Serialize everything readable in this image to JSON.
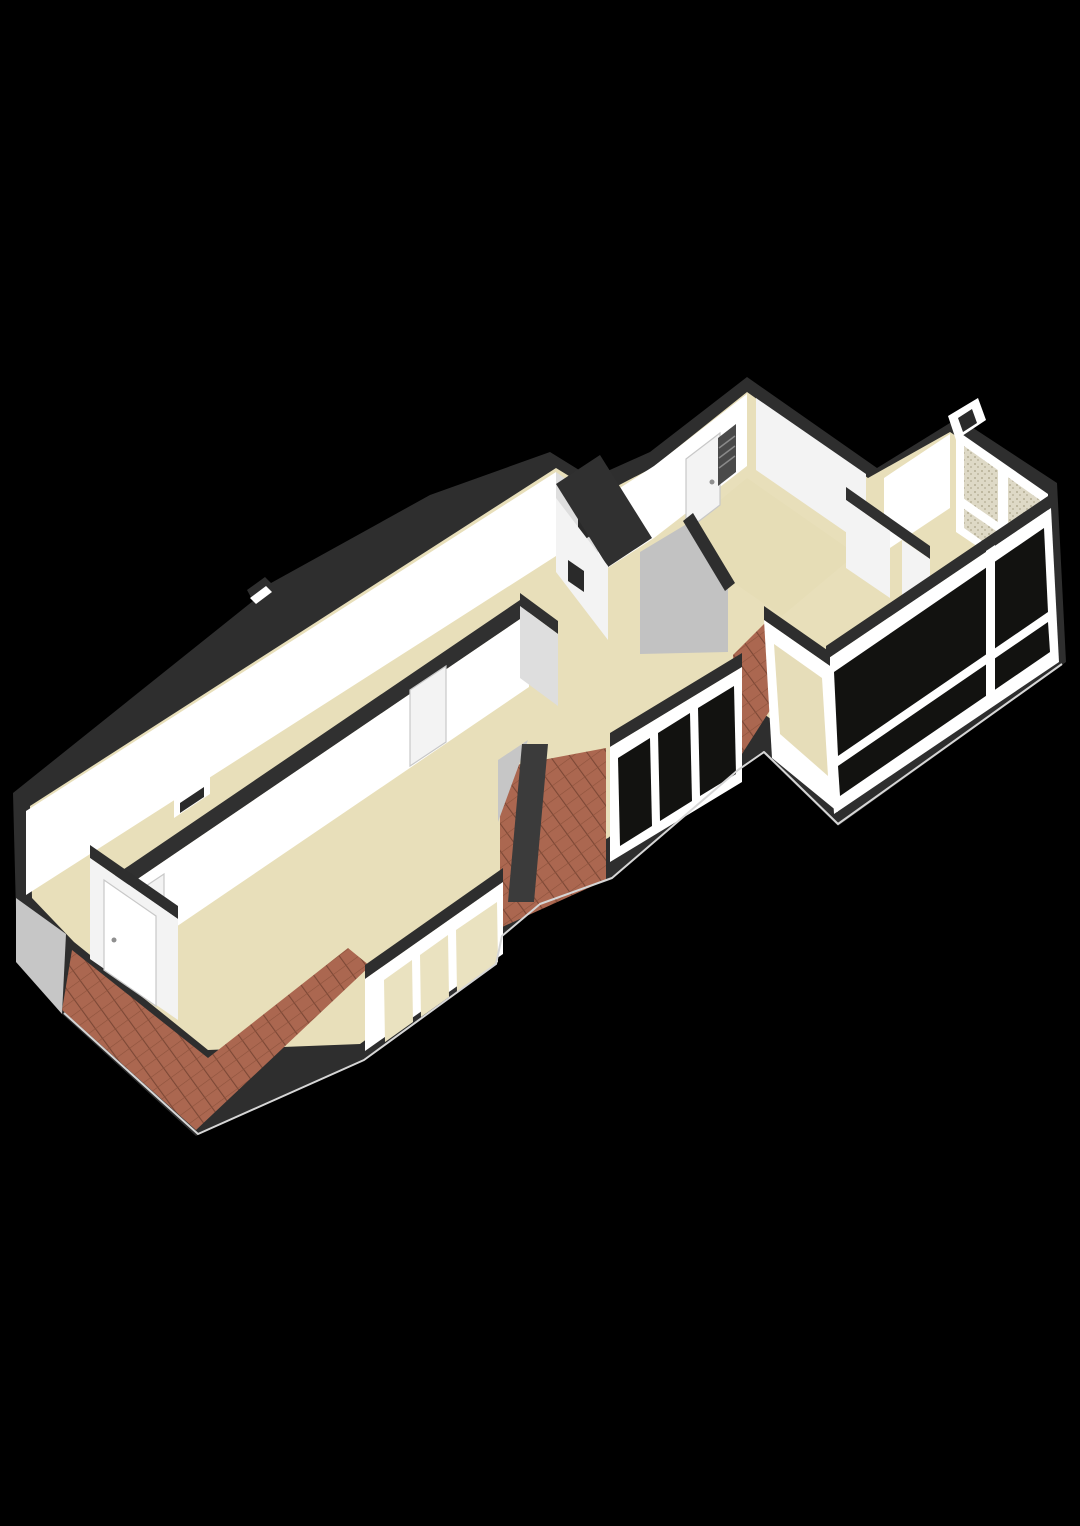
{
  "scene": {
    "canvas": {
      "width": 1080,
      "height": 1526
    },
    "background": "#000000",
    "palette": {
      "wallCap": "#2e2e2e",
      "wallCapSoft": "#303030",
      "wallWhite": "#ffffff",
      "wallLight": "#f3f3f3",
      "wallShade": "#dedede",
      "wallGray": "#c4c4c4",
      "gableGray": "#c6c6c6",
      "chamferGray": "#c2c2c2",
      "floor": "#e8dfba",
      "floorNook": "#e6ddb6",
      "paneDark": "#121210",
      "paneBeige": "#e6ddb9",
      "paneBeigeLight": "#eae2c0",
      "tileBase": "#ab6750",
      "tileLine": "#7c4836",
      "tileRow": "#8d523c",
      "chimney": "#3b3b3b",
      "frostBase": "#ded9c6",
      "frostDot": "#b4ad94",
      "edgeLight": "#d6d6d6",
      "doorFrame": "#c8c8c8",
      "handleGray": "#8f8f8f",
      "slotDark": "#2a2a2a",
      "radiator": "#4a4a4a",
      "radiatorLine": "#8a8a8a"
    },
    "elements": [
      {
        "name": "building-silhouette-walls-cap",
        "kind": "polygon",
        "fill": "wallCap",
        "points": "13,793 253,601 247,590 265,577 271,583 430,495 550,452 592,478 650,452 747,377 877,468 958,418 1057,483 1066,662 838,826 762,752 736,770 610,880 538,906 500,938 494,966 362,1062 196,1136 62,1014 16,912"
      },
      {
        "name": "roof-vent-box",
        "kind": "polygon",
        "fill": "wallWhite",
        "points": "250,598 266,586 272,592 256,604"
      },
      {
        "name": "floor-main",
        "kind": "polygon",
        "fill": "floor",
        "points": "30,806 556,468 600,495 652,468 747,392 868,478 950,432 1046,496 1048,610 834,766 764,714 736,734 608,838 536,872 498,898 494,946 360,1044 208,1050 74,942 32,898"
      },
      {
        "name": "back-wall-face",
        "kind": "polygon",
        "fill": "wallWhite",
        "points": "26,811 556,472 556,556 26,895"
      },
      {
        "name": "back-wall-step-face",
        "kind": "polygon",
        "fill": "wallShade",
        "points": "556,472 598,502 598,584 556,554"
      },
      {
        "name": "step-niche-slot",
        "kind": "polygon",
        "fill": "slotDark",
        "points": "578,503 590,495 590,536 578,544"
      },
      {
        "name": "mid-back-wall-face",
        "kind": "polygon",
        "fill": "wallWhite",
        "points": "598,502 654,466 654,538 598,574"
      },
      {
        "name": "entry-nook-left-wall",
        "kind": "polygon",
        "fill": "wallWhite",
        "points": "654,466 747,394 747,466 654,538"
      },
      {
        "name": "entry-nook-right-wall",
        "kind": "polygon",
        "fill": "wallLight",
        "points": "756,398 866,474 866,546 756,470"
      },
      {
        "name": "entry-nook-floor",
        "kind": "polygon",
        "fill": "floorNook",
        "points": "672,540 747,478 856,554 782,616"
      },
      {
        "name": "entry-door-leaf",
        "kind": "polygon",
        "fill": "wallLight",
        "stroke": "doorFrame",
        "points": "686,459 720,433 720,505 686,531"
      },
      {
        "name": "entry-door-handle",
        "kind": "circle",
        "cx": 712,
        "cy": 482,
        "r": 2.5,
        "fill": "handleGray"
      },
      {
        "name": "radiator-shaft",
        "kind": "polygon",
        "fill": "radiator",
        "points": "718,438 736,424 736,472 718,486"
      },
      {
        "name": "radiator-stripe-1",
        "kind": "polyline",
        "stroke": "radiatorLine",
        "width": 1.5,
        "points": "719,448 735,436"
      },
      {
        "name": "radiator-stripe-2",
        "kind": "polyline",
        "stroke": "radiatorLine",
        "width": 1.5,
        "points": "719,458 735,446"
      },
      {
        "name": "radiator-stripe-3",
        "kind": "polyline",
        "stroke": "radiatorLine",
        "width": 1.5,
        "points": "719,468 735,456"
      },
      {
        "name": "right-back-wall-face",
        "kind": "polygon",
        "fill": "wallWhite",
        "points": "884,478 950,434 950,508 884,552"
      },
      {
        "name": "corner-duct-box",
        "kind": "polygon",
        "fill": "wallWhite",
        "points": "948,416 978,398 986,420 956,440"
      },
      {
        "name": "corner-duct-slot",
        "kind": "polygon",
        "fill": "slotDark",
        "points": "958,418 972,409 977,423 963,432"
      },
      {
        "name": "frosted-window-frame",
        "kind": "polygon",
        "fill": "wallWhite",
        "points": "956,430 1048,494 1048,594 956,532"
      },
      {
        "name": "frosted-window-pane",
        "kind": "polygon",
        "fill": "pattern:speckle",
        "points": "964,446 1040,500 1040,582 964,528"
      },
      {
        "name": "frosted-window-mullion",
        "kind": "polygon",
        "fill": "wallWhite",
        "points": "998,462 1008,469 1008,564 998,557"
      },
      {
        "name": "frosted-window-rail",
        "kind": "polygon",
        "fill": "wallWhite",
        "points": "960,496 1044,554 1044,564 960,506"
      },
      {
        "name": "hall-partition-cap",
        "kind": "polygon",
        "fill": "wallCapSoft",
        "points": "846,487 930,546 930,559 846,500"
      },
      {
        "name": "hall-partition-face-left",
        "kind": "polygon",
        "fill": "wallLight",
        "points": "846,500 890,531 890,598 846,568"
      },
      {
        "name": "hall-partition-face-right",
        "kind": "polygon",
        "fill": "wallLight",
        "points": "902,540 930,559 930,627 902,608"
      },
      {
        "name": "sloped-ceiling-chamfer",
        "kind": "polygon",
        "fill": "chamferGray",
        "points": "640,552 690,522 728,586 728,652 640,654"
      },
      {
        "name": "sloped-ceiling-chamfer-cap",
        "kind": "polygon",
        "fill": "wallCap",
        "points": "683,521 693,513 735,583 725,591"
      },
      {
        "name": "closet-cap",
        "kind": "polygon",
        "fill": "wallCapSoft",
        "points": "556,484 600,455 652,538 608,567"
      },
      {
        "name": "closet-face",
        "kind": "polygon",
        "fill": "wallLight",
        "points": "556,498 608,566 608,640 556,572"
      },
      {
        "name": "closet-niche-slot",
        "kind": "polygon",
        "fill": "slotDark",
        "points": "568,560 584,571 584,592 568,581"
      },
      {
        "name": "longwall-cap",
        "kind": "polygon",
        "fill": "wallCapSoft",
        "points": "108,880 520,600 529,613 117,893"
      },
      {
        "name": "longwall-face",
        "kind": "polygon",
        "fill": "wallWhite",
        "points": "117,893 529,613 529,687 117,967"
      },
      {
        "name": "longwall-hatch-frame",
        "kind": "polygon",
        "fill": "wallWhite",
        "points": "174,800 210,776 210,794 174,818"
      },
      {
        "name": "longwall-hatch-slot",
        "kind": "polygon",
        "fill": "slotDark",
        "points": "180,803 204,787 204,797 180,813"
      },
      {
        "name": "longwall-door-left",
        "kind": "polygon",
        "fill": "wallLight",
        "stroke": "doorFrame",
        "points": "128,898 164,874 164,952 128,976"
      },
      {
        "name": "longwall-door-right",
        "kind": "polygon",
        "fill": "wallLight",
        "stroke": "doorFrame",
        "points": "410,690 446,666 446,742 410,766"
      },
      {
        "name": "room-end-wall-cap",
        "kind": "polygon",
        "fill": "wallCapSoft",
        "points": "520,593 558,621 558,634 520,606"
      },
      {
        "name": "room-end-wall-face",
        "kind": "polygon",
        "fill": "wallShade",
        "points": "520,606 558,634 558,706 520,678"
      },
      {
        "name": "left-front-wall-cap",
        "kind": "polygon",
        "fill": "wallCap",
        "points": "90,845 178,906 178,919 90,858"
      },
      {
        "name": "left-front-wall-face",
        "kind": "polygon",
        "fill": "wallLight",
        "points": "90,858 178,919 178,1020 90,959"
      },
      {
        "name": "left-front-door-leaf",
        "kind": "polygon",
        "fill": "wallWhite",
        "stroke": "doorFrame",
        "points": "104,880 156,916 156,1006 104,970"
      },
      {
        "name": "left-front-door-handle",
        "kind": "circle",
        "cx": 114,
        "cy": 940,
        "r": 2.5,
        "fill": "handleGray"
      },
      {
        "name": "gable-face-gray",
        "kind": "polygon",
        "fill": "gableGray",
        "points": "16,898 66,934 62,1014 16,962"
      },
      {
        "name": "hip-roof-tiles",
        "kind": "polygon",
        "fill": "pattern:tiles",
        "points": "72,950 208,1058 348,948 370,966 196,1130 62,1010"
      },
      {
        "name": "roof-tiles-mid-patch",
        "kind": "polygon",
        "fill": "pattern:tiles",
        "points": "500,768 606,748 606,880 500,928"
      },
      {
        "name": "roof-slope-gray-tri",
        "kind": "polygon",
        "fill": "gableGray",
        "points": "498,760 528,740 498,822"
      },
      {
        "name": "chimney",
        "kind": "polygon",
        "fill": "chimney",
        "points": "522,744 548,744 534,902 508,902"
      },
      {
        "name": "roof-tiles-bay-patch",
        "kind": "polygon",
        "fill": "pattern:tiles",
        "points": "733,655 768,620 774,704 740,757"
      },
      {
        "name": "mid-dormer-cap",
        "kind": "polygon",
        "fill": "wallCap",
        "points": "610,733 742,653 742,667 610,747"
      },
      {
        "name": "mid-dormer-band",
        "kind": "polygon",
        "fill": "wallWhite",
        "points": "610,747 742,667 742,782 610,862"
      },
      {
        "name": "mid-dormer-pane-1",
        "kind": "polygon",
        "fill": "paneDark",
        "points": "618,758 650,738 652,826 620,846"
      },
      {
        "name": "mid-dormer-pane-2",
        "kind": "polygon",
        "fill": "paneDark",
        "points": "658,733 690,713 692,801 660,821"
      },
      {
        "name": "mid-dormer-pane-3",
        "kind": "polygon",
        "fill": "paneDark",
        "points": "698,708 734,686 736,774 700,796"
      },
      {
        "name": "left-dormer-cap",
        "kind": "polygon",
        "fill": "wallCap",
        "points": "365,965 503,868 503,882 365,979"
      },
      {
        "name": "left-dormer-band",
        "kind": "polygon",
        "fill": "wallWhite",
        "points": "365,979 503,882 503,954 365,1051"
      },
      {
        "name": "left-dormer-pane-1",
        "kind": "polygon",
        "fill": "paneBeigeLight",
        "points": "384,980 412,960 413,1022 385,1042"
      },
      {
        "name": "left-dormer-pane-2",
        "kind": "polygon",
        "fill": "paneBeigeLight",
        "points": "420,955 448,935 449,997 421,1017"
      },
      {
        "name": "left-dormer-pane-3",
        "kind": "polygon",
        "fill": "paneBeigeLight",
        "points": "456,930 497,902 498,962 457,992"
      },
      {
        "name": "right-window-band-cap",
        "kind": "polygon",
        "fill": "wallCap",
        "points": "826,646 1051,494 1051,508 826,660"
      },
      {
        "name": "right-window-band",
        "kind": "polygon",
        "fill": "wallWhite",
        "points": "826,660 1051,508 1059,662 834,814"
      },
      {
        "name": "right-window-pane-upper",
        "kind": "polygon",
        "fill": "paneDark",
        "points": "834,672 1044,528 1048,612 838,756"
      },
      {
        "name": "right-window-pane-lower",
        "kind": "polygon",
        "fill": "paneDark",
        "points": "838,766 1048,622 1050,652 840,796"
      },
      {
        "name": "right-window-mullion",
        "kind": "polygon",
        "fill": "wallWhite",
        "points": "986,551 995,545 995,702 986,708"
      },
      {
        "name": "bay-side-cap",
        "kind": "polygon",
        "fill": "wallCap",
        "points": "764,606 830,652 830,666 764,620"
      },
      {
        "name": "bay-side-frame",
        "kind": "polygon",
        "fill": "wallWhite",
        "points": "764,620 830,666 838,812 772,758"
      },
      {
        "name": "bay-side-pane",
        "kind": "polygon",
        "fill": "paneBeige",
        "points": "774,644 822,678 828,776 780,734"
      },
      {
        "name": "plinth-light-edge",
        "kind": "polyline",
        "stroke": "edgeLight",
        "width": 2,
        "points": "1062,664 838,824 764,752 738,770 612,878 540,904 502,936 496,964 364,1060 198,1134 64,1013"
      }
    ]
  }
}
